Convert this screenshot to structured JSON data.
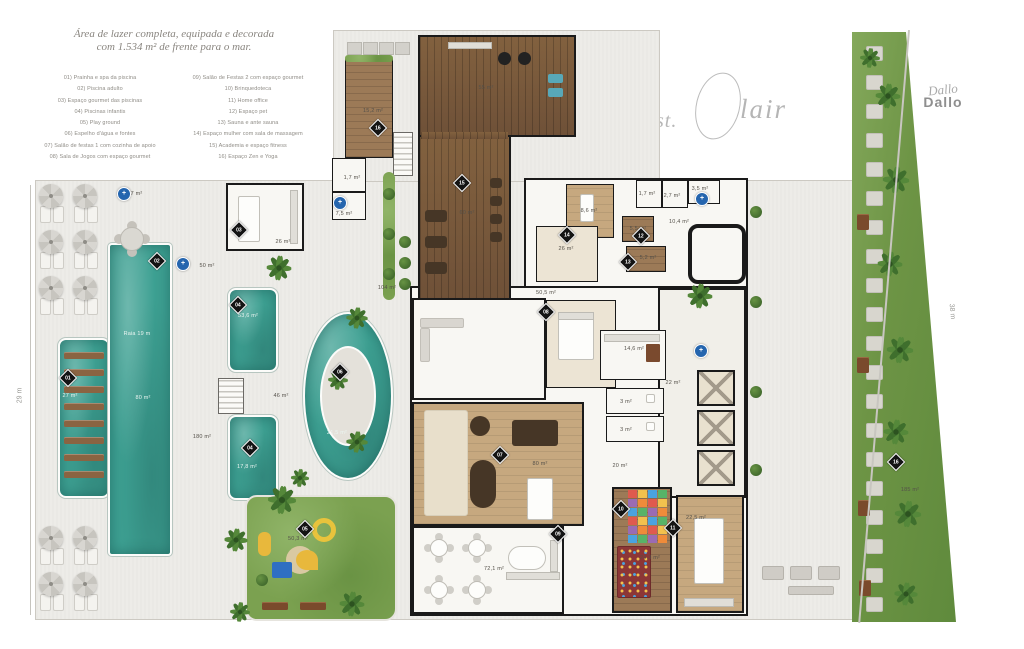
{
  "header": {
    "title_line1": "Área de lazer completa, equipada e decorada",
    "title_line2": "com 1.534 m² de frente para o mar.",
    "legend_left": [
      "01) Prainha e spa da piscina",
      "02) Piscina adulto",
      "03) Espaço gourmet das piscinas",
      "04) Piscinas infantis",
      "05) Play ground",
      "06) Espelho d'água e fontes",
      "07) Salão de festas 1 com cozinha de apoio",
      "08) Sala de Jogos com espaço gourmet"
    ],
    "legend_right": [
      "09) Salão de Festas 2 com espaço gourmet",
      "10) Brinquedoteca",
      "11) Home office",
      "12) Espaço pet",
      "13) Sauna e ante sauna",
      "14) Espaço mulher com sala de massagem",
      "15) Academia e espaço fitness",
      "16) Espaço Zen e Yoga"
    ]
  },
  "logos": {
    "stclair_prefix": "st.",
    "stclair_rest": "lair",
    "builder_script": "Dallo",
    "builder_bold": "Dallo"
  },
  "dimensions": {
    "left": "29 m",
    "right": "38 m"
  },
  "plan": {
    "area_labels": [
      {
        "text": "4,7 m²",
        "x": 134,
        "y": 194
      },
      {
        "text": "50 m²",
        "x": 207,
        "y": 266
      },
      {
        "text": "26 m²",
        "x": 283,
        "y": 242
      },
      {
        "text": "15,2 m²",
        "x": 373,
        "y": 111
      },
      {
        "text": "1,7 m²",
        "x": 352,
        "y": 178
      },
      {
        "text": "7,5 m²",
        "x": 344,
        "y": 214
      },
      {
        "text": "55 m²",
        "x": 486,
        "y": 88
      },
      {
        "text": "60 m²",
        "x": 467,
        "y": 213
      },
      {
        "text": "104 m²",
        "x": 387,
        "y": 288
      },
      {
        "text": "50,5 m²",
        "x": 546,
        "y": 293
      },
      {
        "text": "8,6 m²",
        "x": 589,
        "y": 211
      },
      {
        "text": "26 m²",
        "x": 566,
        "y": 249
      },
      {
        "text": "1,7 m²",
        "x": 647,
        "y": 194
      },
      {
        "text": "2,7 m²",
        "x": 672,
        "y": 196
      },
      {
        "text": "3,5 m²",
        "x": 700,
        "y": 189
      },
      {
        "text": "10,4 m²",
        "x": 679,
        "y": 222
      },
      {
        "text": "5,5 m²",
        "x": 638,
        "y": 229
      },
      {
        "text": "5,2 m²",
        "x": 648,
        "y": 258
      },
      {
        "text": "Raia 19 m",
        "x": 137,
        "y": 334,
        "light": true
      },
      {
        "text": "80 m²",
        "x": 143,
        "y": 398,
        "light": true
      },
      {
        "text": "27 m²",
        "x": 70,
        "y": 396,
        "light": true
      },
      {
        "text": "53,6 m²",
        "x": 248,
        "y": 316,
        "light": true
      },
      {
        "text": "17,8 m²",
        "x": 247,
        "y": 467,
        "light": true
      },
      {
        "text": "180 m²",
        "x": 202,
        "y": 437
      },
      {
        "text": "46 m²",
        "x": 281,
        "y": 396
      },
      {
        "text": "21,5 m²",
        "x": 337,
        "y": 433,
        "light": true
      },
      {
        "text": "14,6 m²",
        "x": 634,
        "y": 349
      },
      {
        "text": "22 m²",
        "x": 673,
        "y": 383
      },
      {
        "text": "3 m²",
        "x": 626,
        "y": 402
      },
      {
        "text": "3 m²",
        "x": 626,
        "y": 430
      },
      {
        "text": "20 m²",
        "x": 620,
        "y": 466
      },
      {
        "text": "80 m²",
        "x": 540,
        "y": 464
      },
      {
        "text": "72,1 m²",
        "x": 494,
        "y": 569
      },
      {
        "text": "24,3 m²",
        "x": 650,
        "y": 558
      },
      {
        "text": "22,5 m²",
        "x": 696,
        "y": 518
      },
      {
        "text": "50,3 m²",
        "x": 298,
        "y": 539
      },
      {
        "text": "185 m²",
        "x": 910,
        "y": 490
      }
    ],
    "markers": [
      {
        "n": "01",
        "x": 68,
        "y": 378
      },
      {
        "n": "02",
        "x": 157,
        "y": 261
      },
      {
        "n": "03",
        "x": 239,
        "y": 230
      },
      {
        "n": "04",
        "x": 238,
        "y": 305
      },
      {
        "n": "04",
        "x": 250,
        "y": 448
      },
      {
        "n": "05",
        "x": 305,
        "y": 529
      },
      {
        "n": "06",
        "x": 340,
        "y": 372
      },
      {
        "n": "07",
        "x": 500,
        "y": 455
      },
      {
        "n": "08",
        "x": 546,
        "y": 312
      },
      {
        "n": "09",
        "x": 558,
        "y": 534
      },
      {
        "n": "10",
        "x": 621,
        "y": 509
      },
      {
        "n": "11",
        "x": 673,
        "y": 528
      },
      {
        "n": "12",
        "x": 641,
        "y": 236
      },
      {
        "n": "13",
        "x": 628,
        "y": 262
      },
      {
        "n": "14",
        "x": 567,
        "y": 235
      },
      {
        "n": "15",
        "x": 462,
        "y": 183
      },
      {
        "n": "16",
        "x": 378,
        "y": 128
      },
      {
        "n": "16",
        "x": 896,
        "y": 462
      }
    ],
    "blue_markers": [
      {
        "x": 124,
        "y": 194
      },
      {
        "x": 183,
        "y": 264
      },
      {
        "x": 340,
        "y": 203
      },
      {
        "x": 702,
        "y": 199
      },
      {
        "x": 701,
        "y": 351
      }
    ],
    "blue_marker_glyph": "+"
  },
  "colors": {
    "pool": "#3da092",
    "wood": "#82613f",
    "grass": "#7ba150",
    "ground": "#edece8",
    "wall": "#1a1a1a",
    "marker_blue": "#2565ae"
  }
}
